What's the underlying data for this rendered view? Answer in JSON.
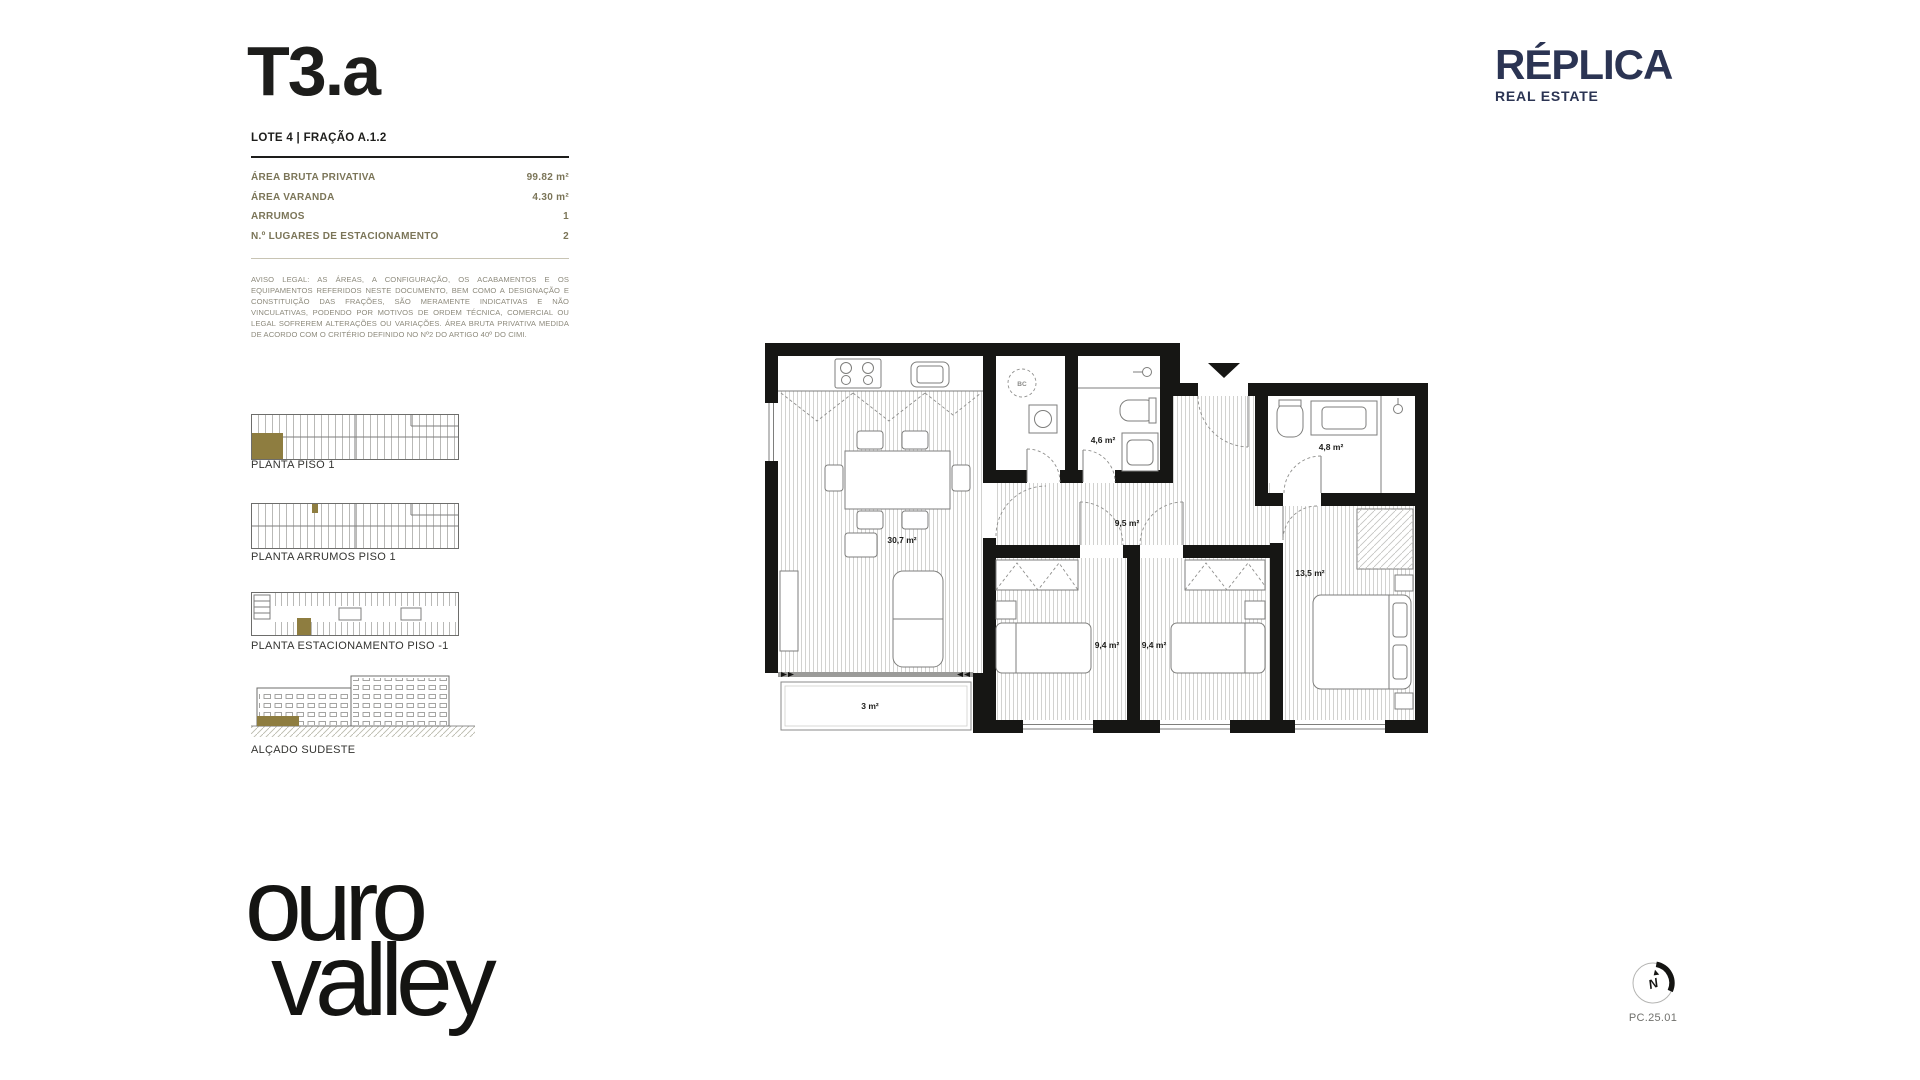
{
  "header": {
    "title": "T3.a",
    "lot": "LOTE 4 | FRAÇÃO A.1.2"
  },
  "specs": {
    "rows": [
      {
        "label": "ÁREA BRUTA PRIVATIVA",
        "value": "99.82 m²"
      },
      {
        "label": "ÁREA VARANDA",
        "value": "4.30 m²"
      },
      {
        "label": "ARRUMOS",
        "value": "1"
      },
      {
        "label": "N.º LUGARES DE ESTACIONAMENTO",
        "value": "2"
      }
    ]
  },
  "legal": "AVISO LEGAL: AS ÁREAS, A CONFIGURAÇÃO, OS ACABAMENTOS E OS EQUIPAMENTOS REFERIDOS NESTE DOCUMENTO, BEM COMO A DESIGNAÇÃO E CONSTITUIÇÃO DAS FRAÇÕES, SÃO MERAMENTE INDICATIVAS E NÃO VINCULATIVAS, PODENDO POR MOTIVOS DE ORDEM TÉCNICA, COMERCIAL OU LEGAL SOFREREM ALTERAÇÕES OU VARIAÇÕES. ÁREA BRUTA PRIVATIVA MEDIDA DE ACORDO COM O CRITÉRIO DEFINIDO NO Nº2 DO ARTIGO 40º DO CIMI.",
  "thumbnails": [
    {
      "label": "PLANTA PISO 1"
    },
    {
      "label": "PLANTA ARRUMOS PISO 1"
    },
    {
      "label": "PLANTA ESTACIONAMENTO PISO -1"
    },
    {
      "label": "ALÇADO SUDESTE"
    }
  ],
  "floorplan": {
    "rooms": {
      "living": "30,7 m²",
      "hall": "9,5 m²",
      "bath1": "4,6 m²",
      "bath2": "4,8 m²",
      "bedroom1": "9,4 m²",
      "bedroom2": "9,4 m²",
      "bedroom3": "13,5 m²",
      "balcony": "3 m²",
      "heater": "BC"
    }
  },
  "brand": {
    "name": "RÉPLICA",
    "tagline": "REAL ESTATE"
  },
  "project": {
    "logo_line1": "ouro",
    "logo_line2": "valley"
  },
  "footer": {
    "compass_letter": "N",
    "code": "PC.25.01"
  },
  "colors": {
    "accent_gold": "#8e7d40",
    "navy": "#2b3453",
    "olive": "#7b7558",
    "ink": "#1d1d1b"
  }
}
